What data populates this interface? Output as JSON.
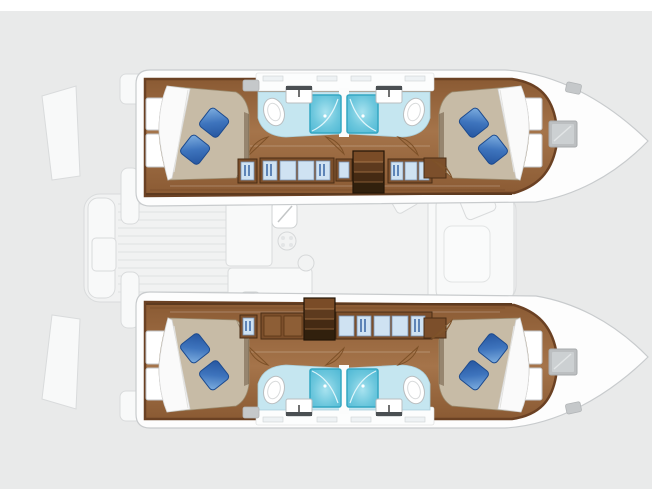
{
  "page": {
    "background": "#e9eaea",
    "top_strip_color": "#ffffff"
  },
  "diagram": {
    "type": "boat-floor-plan",
    "vessel": "catamaran",
    "view": "top-down interior layout, bows pointing right",
    "layout_summary": "4 double cabins and 4 bathrooms with showers (2 per hull), central saloon, galley and aft cockpit shown ghosted",
    "hulls": [
      {
        "name": "upper-hull",
        "rooms": [
          "aft-double-cabin",
          "aft-bathroom-with-shower",
          "forward-bathroom-with-shower",
          "forward-double-cabin"
        ],
        "features": [
          "bed-with-two-blue-pillows",
          "hanging-lockers",
          "companionway-stairs",
          "bow-deck-hatch",
          "deck-vent"
        ]
      },
      {
        "name": "lower-hull",
        "rooms": [
          "aft-double-cabin",
          "aft-bathroom-with-shower",
          "forward-bathroom-with-shower",
          "forward-double-cabin"
        ],
        "features": [
          "bed-with-two-blue-pillows",
          "hanging-lockers",
          "companionway-stairs",
          "bow-deck-hatch",
          "deck-vent"
        ]
      }
    ],
    "bridgedeck_ghost": {
      "ghosted": true,
      "features": [
        "galley-counter",
        "galley-sink",
        "stove-burners",
        "saloon-sofa",
        "saloon-armchair",
        "cockpit-bench",
        "cockpit-table",
        "teak-deck-planking",
        "transom-steps"
      ]
    },
    "colors": {
      "bg": "#e9eaea",
      "strip": "#ffffff",
      "hull-fill": "#fdfdfd",
      "hull-edge": "#c8cbcd",
      "wood-trim": "#6b4123",
      "cabinet-wood": "#7c4f2b",
      "bath-floor": "#c5e6f0",
      "shower-edge": "#35a7c2",
      "ghost-fill": "#f1f2f2",
      "ghost-stroke": "#d9dbdc",
      "mattress": "#c7bba6",
      "pillow-dark": "#1c4a8e",
      "hatch": "#bcbfc1"
    }
  }
}
